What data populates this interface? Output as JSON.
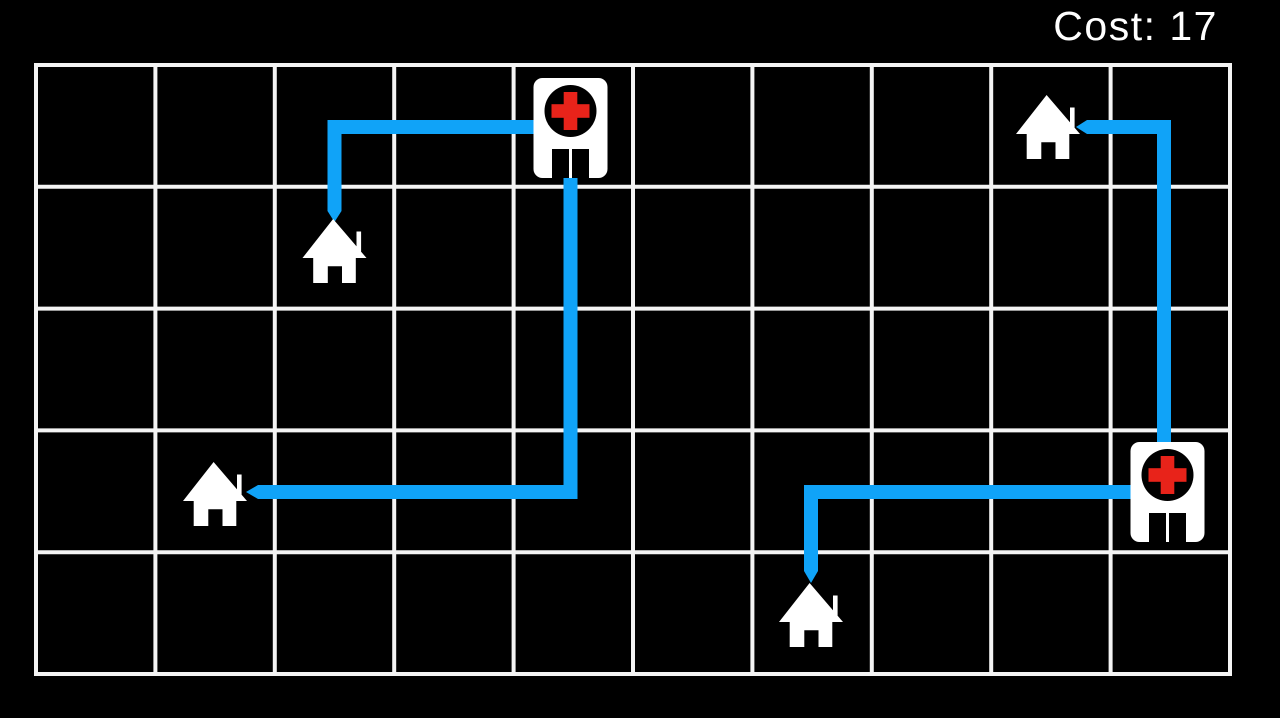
{
  "hud": {
    "cost_label": "Cost: 17",
    "cost_value": 17
  },
  "colors": {
    "background": "#000000",
    "grid_line": "#f4f4f4",
    "path_blue": "#10a3f8",
    "building_white": "#ffffff",
    "cross_red": "#e8231a",
    "icon_black": "#000000"
  },
  "grid": {
    "cols": 10,
    "rows": 5,
    "x": 36,
    "y": 65,
    "cell_width": 119.4,
    "cell_height": 121.8,
    "line_width": 4
  },
  "path_width": 14,
  "buildings": {
    "houses": [
      {
        "id": "house-a",
        "col": 2,
        "row": 1,
        "cx": 334.5,
        "cy": 251
      },
      {
        "id": "house-b",
        "col": 1,
        "row": 3,
        "cx": 215,
        "cy": 494
      },
      {
        "id": "house-c",
        "col": 6,
        "row": 4,
        "cx": 811,
        "cy": 615
      },
      {
        "id": "house-d",
        "col": 8,
        "row": 0,
        "cx": 1048,
        "cy": 127
      }
    ],
    "hospitals": [
      {
        "id": "hospital-1",
        "col": 4,
        "row": 0,
        "cx": 570.5,
        "cy": 128
      },
      {
        "id": "hospital-2",
        "col": 9,
        "row": 3,
        "cx": 1167.5,
        "cy": 492
      }
    ]
  },
  "paths": [
    {
      "id": "route-hospital1-house-a",
      "from": "hospital-1",
      "to": "house-a",
      "cost": 3,
      "points": [
        [
          334.5,
          211
        ],
        [
          334.5,
          127
        ],
        [
          534,
          127
        ]
      ],
      "arrow": [
        [
          327.5,
          211
        ],
        [
          341.5,
          211
        ],
        [
          334.5,
          222
        ]
      ]
    },
    {
      "id": "route-hospital1-house-b",
      "from": "hospital-1",
      "to": "house-b",
      "cost": 6,
      "points": [
        [
          570.5,
          177
        ],
        [
          570.5,
          492
        ],
        [
          258,
          492
        ]
      ],
      "arrow": [
        [
          258,
          485
        ],
        [
          258,
          499
        ],
        [
          246,
          492
        ]
      ]
    },
    {
      "id": "route-hospital2-house-c",
      "from": "hospital-2",
      "to": "house-c",
      "cost": 4,
      "points": [
        [
          811,
          571
        ],
        [
          811,
          492
        ],
        [
          1131,
          492
        ]
      ],
      "arrow": [
        [
          804,
          571
        ],
        [
          818,
          571
        ],
        [
          811,
          583
        ]
      ]
    },
    {
      "id": "route-hospital2-house-d",
      "from": "hospital-2",
      "to": "house-d",
      "cost": 4,
      "points": [
        [
          1087,
          127
        ],
        [
          1164,
          127
        ],
        [
          1164,
          443
        ]
      ],
      "arrow": [
        [
          1087,
          120
        ],
        [
          1087,
          134
        ],
        [
          1076,
          127
        ]
      ]
    }
  ]
}
